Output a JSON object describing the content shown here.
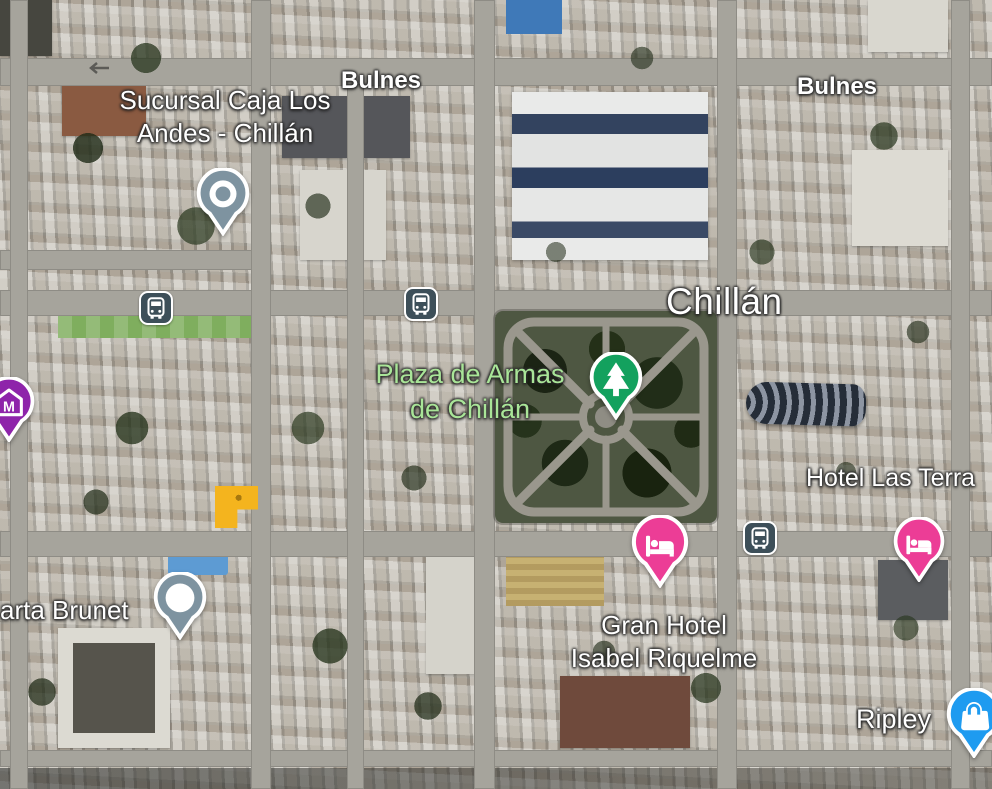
{
  "map": {
    "view": "satellite",
    "city_label": "Chillán",
    "street_labels": {
      "bulnes_west": "Bulnes",
      "bulnes_east": "Bulnes"
    },
    "poi_labels": {
      "sucursal_line1": "Sucursal Caja Los",
      "sucursal_line2": "Andes - Chillán",
      "plaza_line1": "Plaza de Armas",
      "plaza_line2": "de Chillán",
      "hotel_las_terrazas": "Hotel Las Terra",
      "gran_hotel_line1": "Gran Hotel",
      "gran_hotel_line2": "Isabel Riquelme",
      "marta_brunet": "arta Brunet",
      "ripley": "Ripley"
    },
    "pins": [
      {
        "name": "poi-pin-sucursal",
        "glyph": "dot-icon",
        "color": "#7E93A0"
      },
      {
        "name": "poi-pin-marta-brunet",
        "glyph": "dot-icon",
        "color": "#7E93A0"
      },
      {
        "name": "park-pin-plaza",
        "glyph": "tree-icon",
        "color": "#13A15E"
      },
      {
        "name": "hotel-pin-gran-hotel",
        "glyph": "bed-icon",
        "color": "#EC3D96"
      },
      {
        "name": "hotel-pin-las-terrazas",
        "glyph": "bed-icon",
        "color": "#EC3D96"
      },
      {
        "name": "museum-pin",
        "glyph": "museum-building-icon",
        "color": "#8E24AA",
        "letter": "M"
      },
      {
        "name": "store-pin-ripley",
        "glyph": "shopping-bag-icon",
        "color": "#1E9BF0"
      },
      {
        "name": "bus-stop-icon-west",
        "glyph": "bus-icon",
        "color": "#3D4F59"
      },
      {
        "name": "bus-stop-icon-center",
        "glyph": "bus-icon",
        "color": "#3D4F59"
      },
      {
        "name": "bus-stop-icon-east",
        "glyph": "bus-icon",
        "color": "#3D4F59"
      }
    ],
    "colors": {
      "poi_pin": "#7E93A0",
      "park_pin": "#13A15E",
      "hotel_pin": "#EC3D96",
      "museum_pin": "#8E24AA",
      "store_pin": "#1E9BF0",
      "transit_bg": "#3D4F59",
      "park_label_text": "#A9E598",
      "road": "#A6A49C",
      "plaza_green": "#4E5742",
      "highlighted_building": "#F4B41E"
    },
    "museum_letter": "M"
  }
}
